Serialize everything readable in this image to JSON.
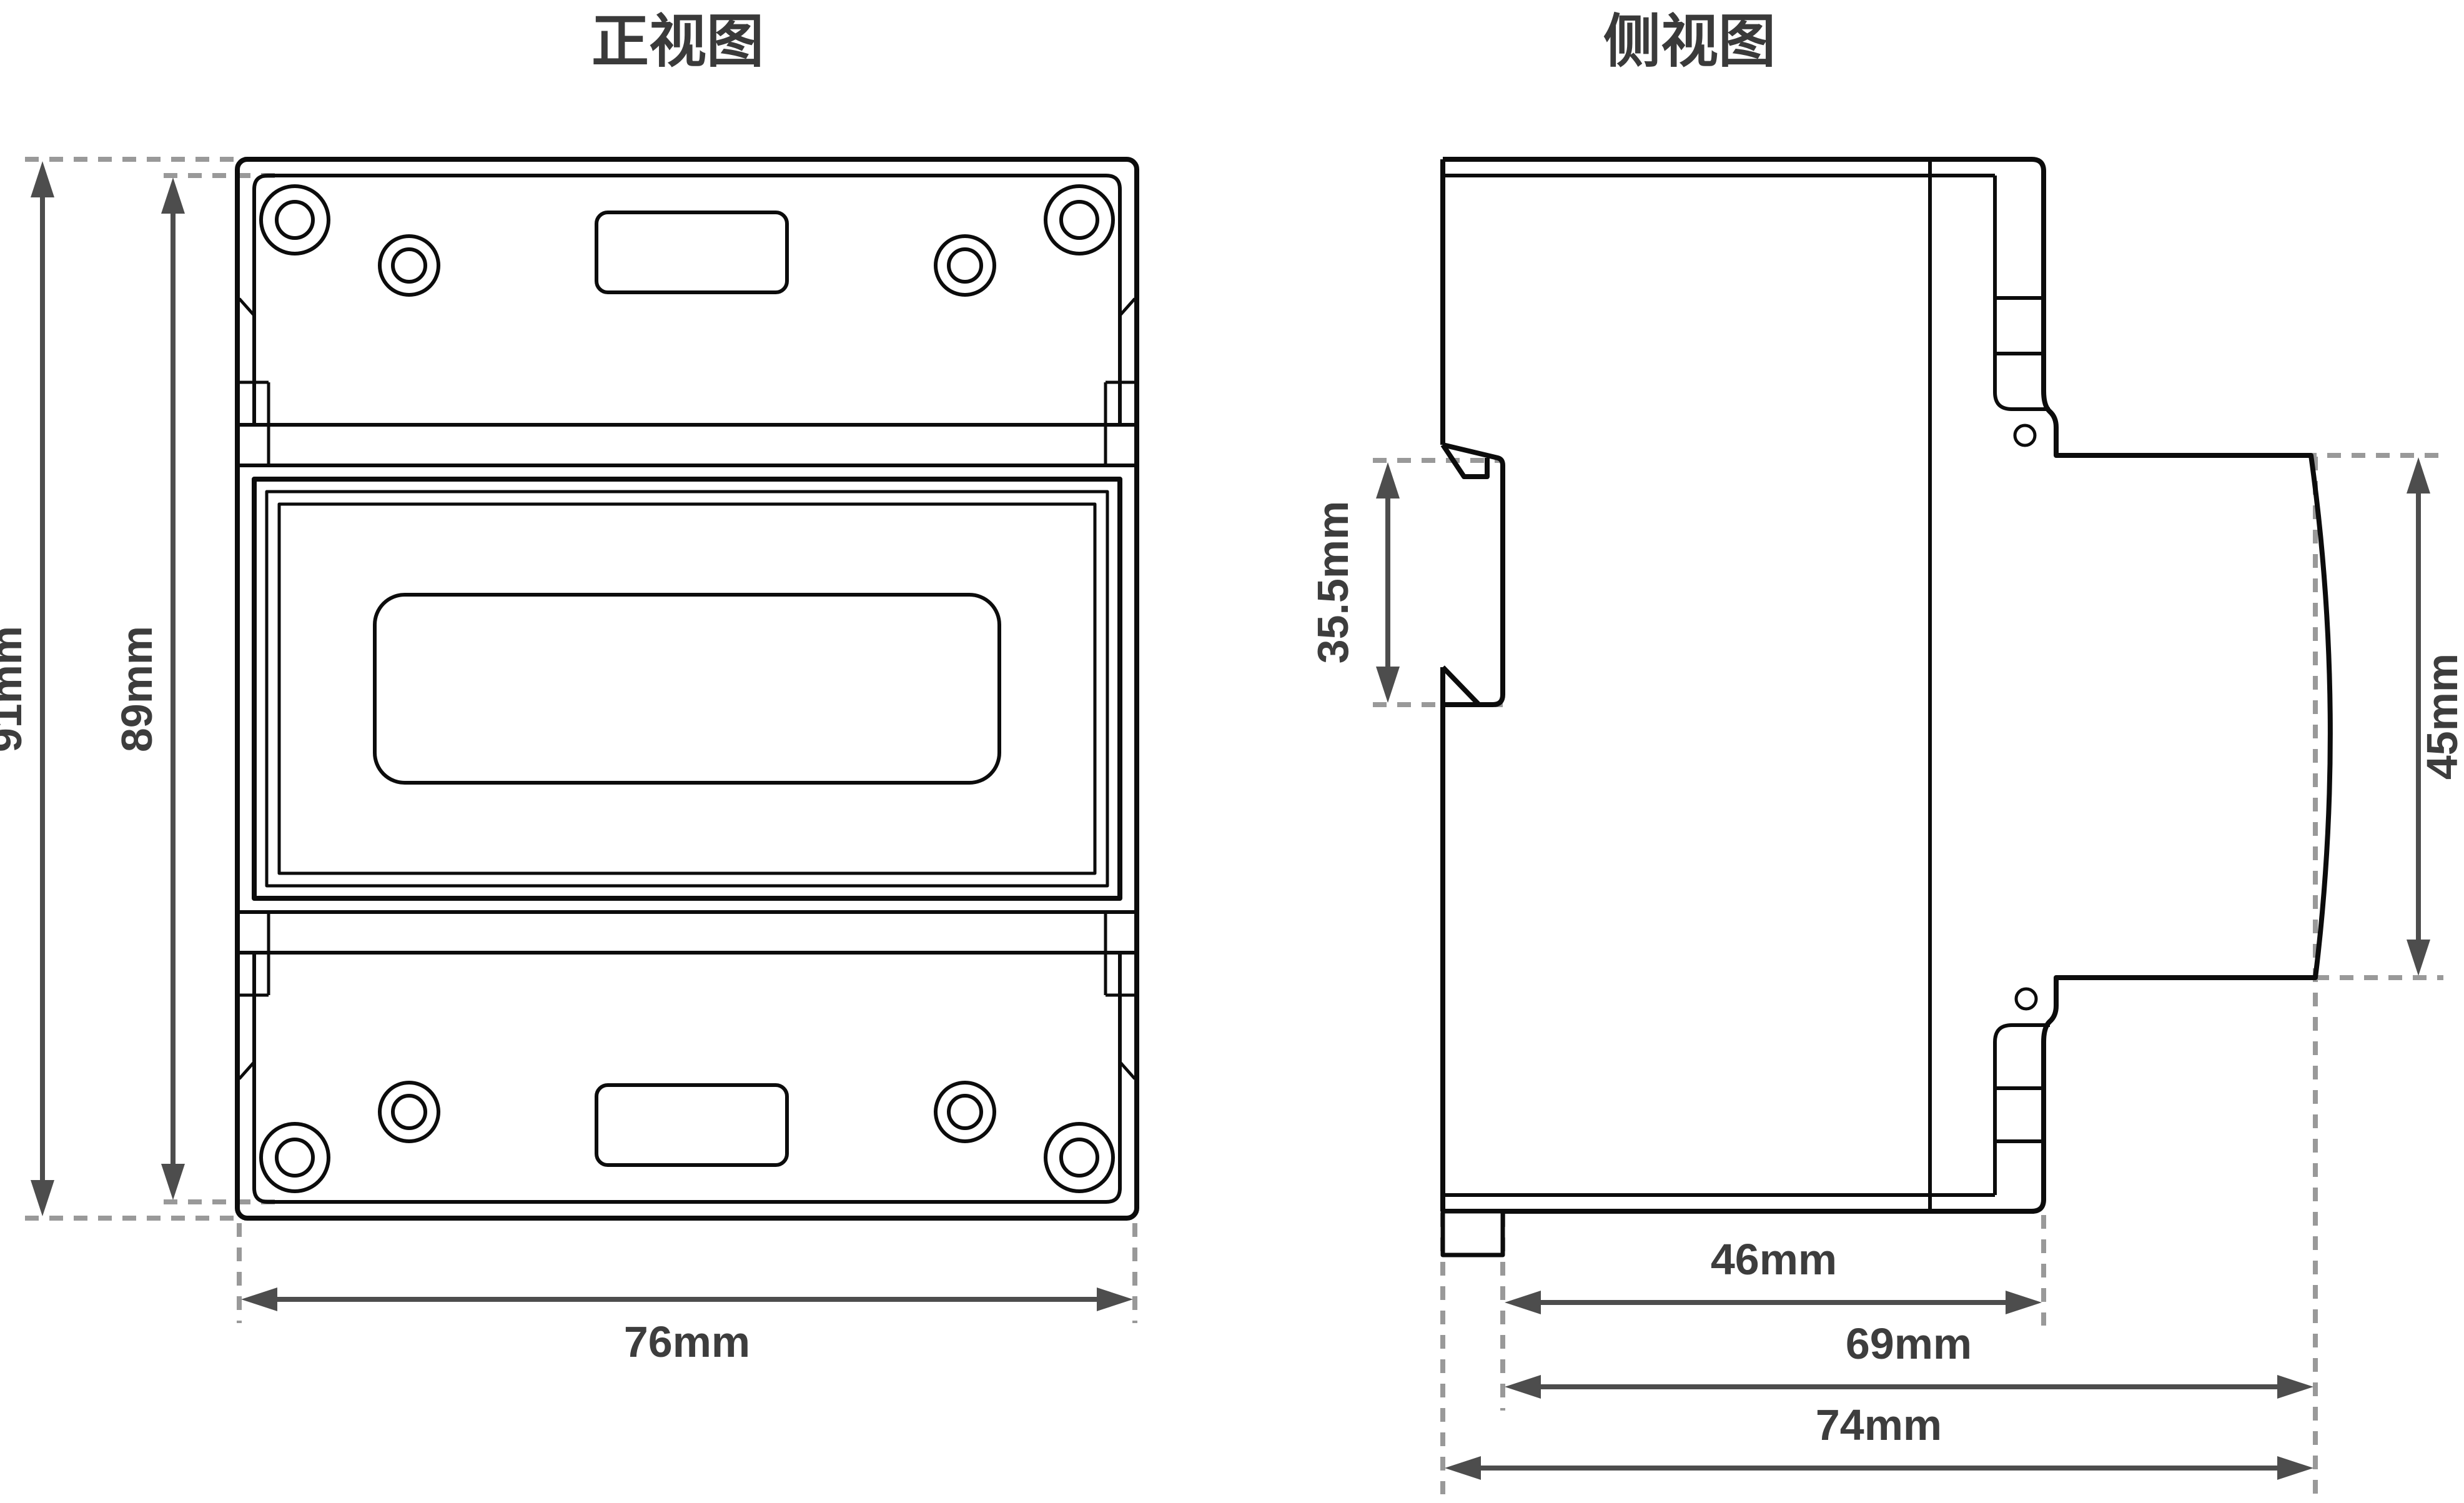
{
  "front_view": {
    "title": "正视图",
    "dimensions": {
      "overall_height": "91mm",
      "cover_height": "89mm",
      "overall_width": "76mm"
    }
  },
  "side_view": {
    "title": "侧视图",
    "dimensions": {
      "rail_slot_height": "35.5mm",
      "front_face_height": "45mm",
      "body_depth": "46mm",
      "front_depth": "69mm",
      "overall_depth": "74mm"
    }
  },
  "colors": {
    "outline": "#0c0c0c",
    "dimension_line": "#4d4d4d",
    "extension_dash": "#999999",
    "label_text": "#3d3d3d",
    "background": "#ffffff"
  }
}
